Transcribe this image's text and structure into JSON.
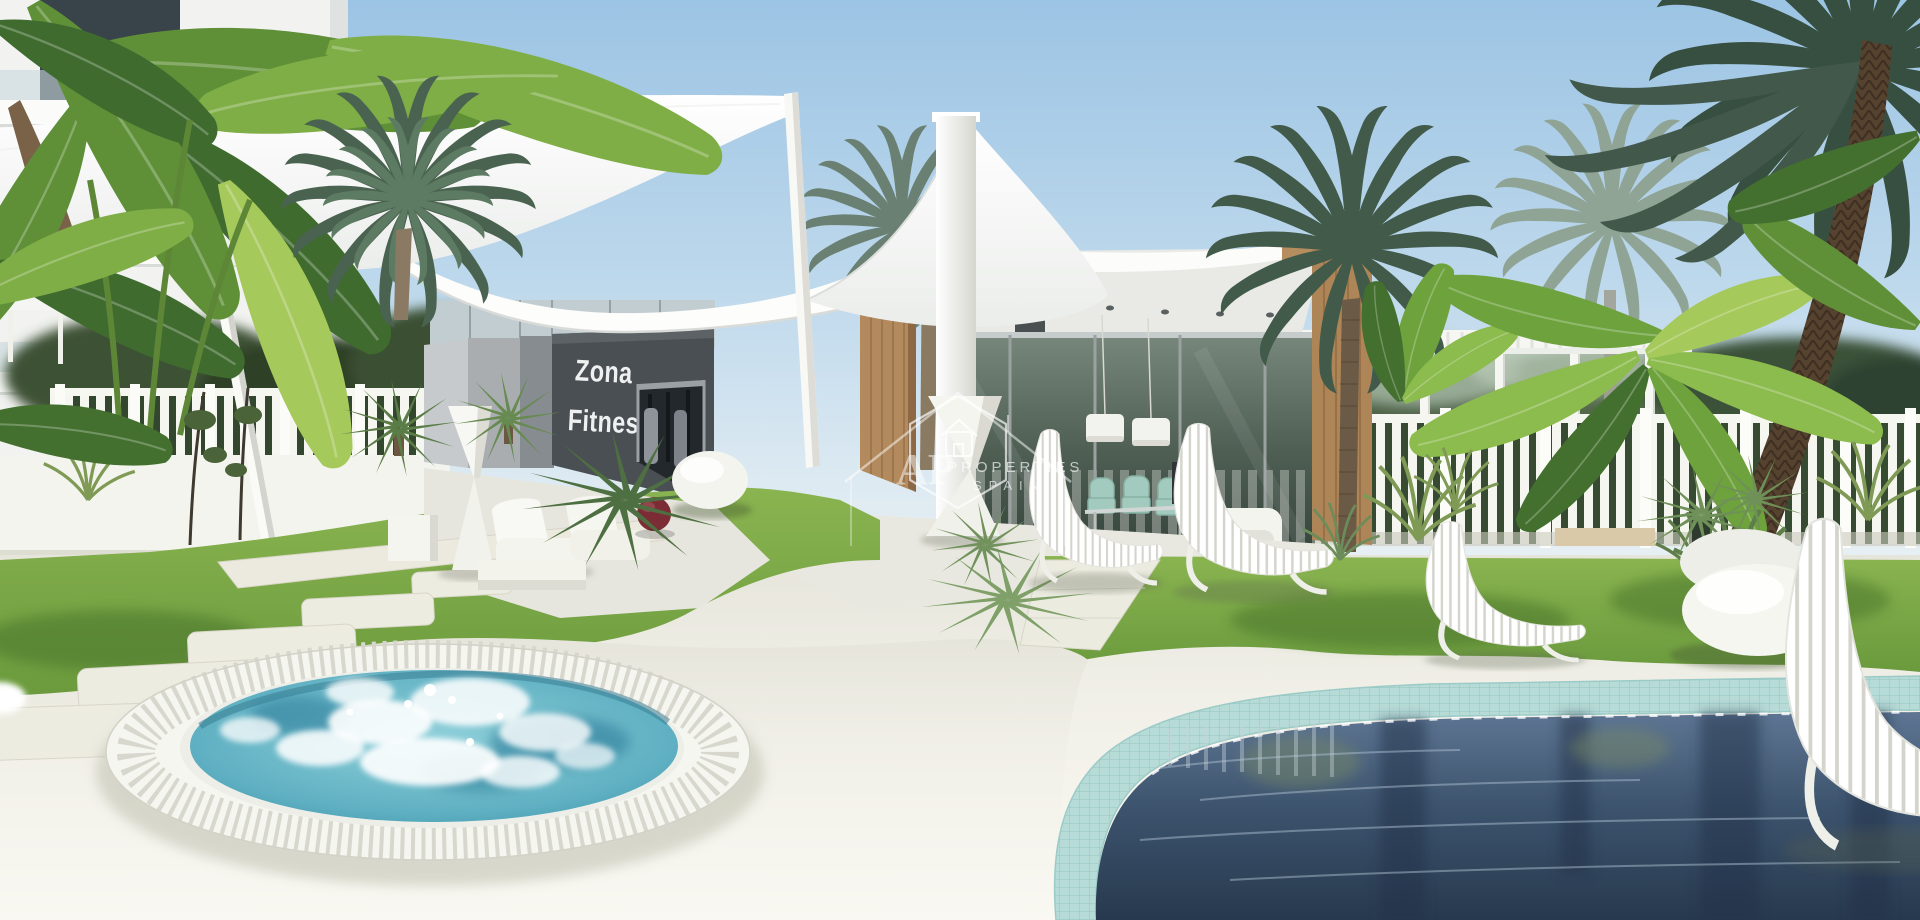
{
  "signage": {
    "line1": "Zona",
    "line2": "Fitness"
  },
  "watermark": {
    "initials": "AP",
    "name": "PROPERTIES",
    "region": "SPAIN",
    "icon": "house-hexagon-icon"
  },
  "palette": {
    "sky_top": "#9cc4e4",
    "sky_horizon": "#eef4f5",
    "sail_white": "#fbfbf8",
    "canopy_white": "#fdfdfb",
    "sign_wall_dark": "#4a4f54",
    "wood_cladding": "#b28a5d",
    "glass_reflection": "#55654f",
    "grass_green": "#7aa742",
    "deck_white": "#f1f0e8",
    "paving_stone": "#eceade",
    "fence_white": "#f6f6f1",
    "pergola_white": "#f6f6f2",
    "spa_water_turquoise": "#5fb0c2",
    "spa_foam_white": "#ffffff",
    "pool_tile_turquoise": "#aed6d2",
    "pool_water_deep": "#31475f",
    "exercise_ball_red": "#7b2c34",
    "mint_chair": "#a3cabe",
    "palm_frond_green": "#47604b",
    "banana_leaf_green": "#7fae46",
    "trunk_brown": "#55422f",
    "pebble_white": "#f4f4ef",
    "lounger_white": "#ffffff"
  }
}
